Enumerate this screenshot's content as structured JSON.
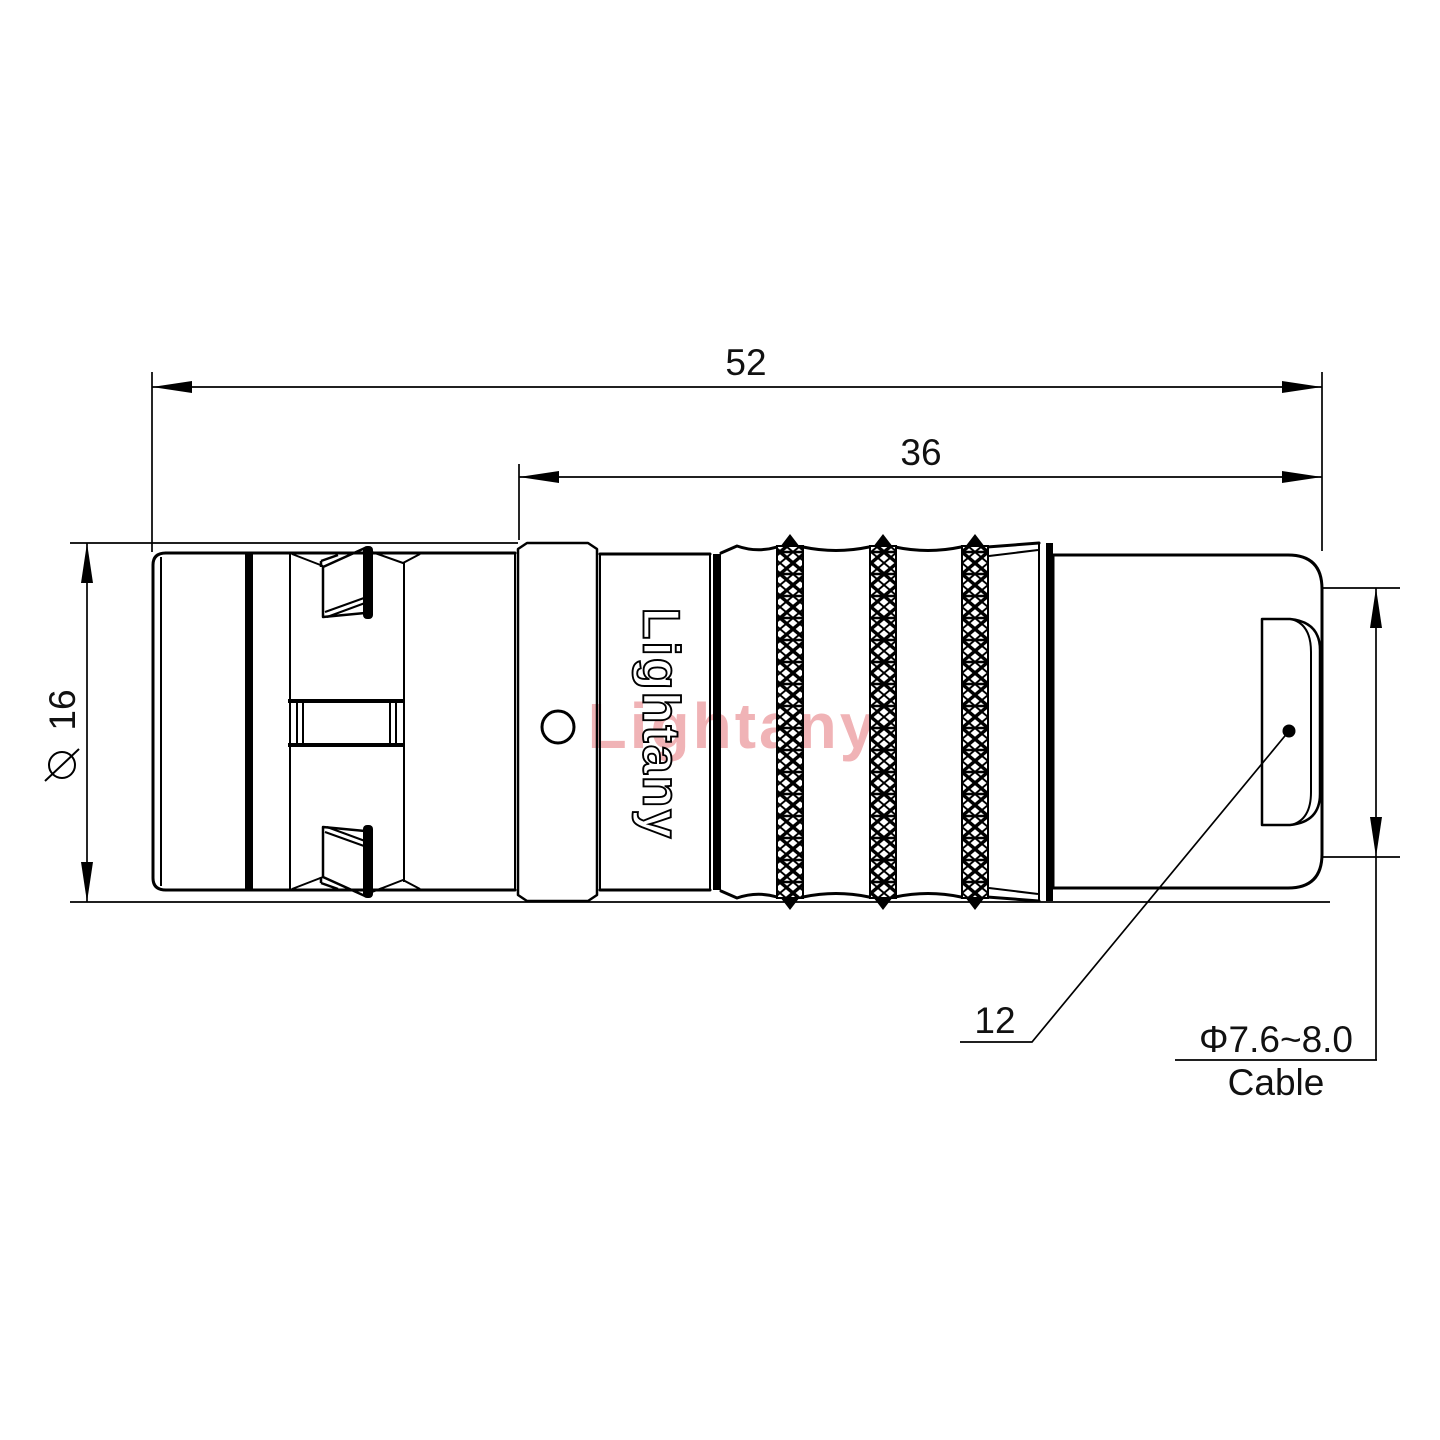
{
  "watermark": {
    "text": "Lightany",
    "color": "#f0b3b6"
  },
  "brand": {
    "vertical_text": "Lightany"
  },
  "dims": {
    "overall_length": "52",
    "rear_length": "36",
    "diameter": "16",
    "boot": "12",
    "cable_range": "Φ7.6~8.0",
    "cable_word": "Cable"
  },
  "colors": {
    "line": "#000000"
  }
}
